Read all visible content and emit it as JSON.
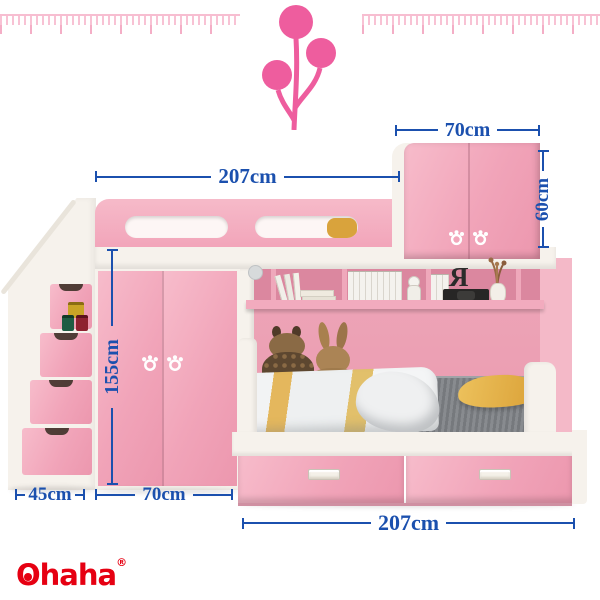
{
  "brand": {
    "initial": "O",
    "rest": "haha",
    "trademark": "®",
    "color": "#e60012"
  },
  "annotations": {
    "upper_bed_width": "207cm",
    "cabinet_width": "70cm",
    "cabinet_height": "60cm",
    "wardrobe_height": "155cm",
    "stairs_depth": "45cm",
    "wardrobe_width": "70cm",
    "lower_bed_width": "207cm"
  },
  "decor": {
    "shelf_letter": "R"
  },
  "colors": {
    "dimension_blue": "#1b50ae",
    "furniture_pink": "#f2a6ba",
    "balloon_pink": "#ee5d9e",
    "frame_white": "#f6f2ec",
    "brand_red": "#e60012"
  }
}
